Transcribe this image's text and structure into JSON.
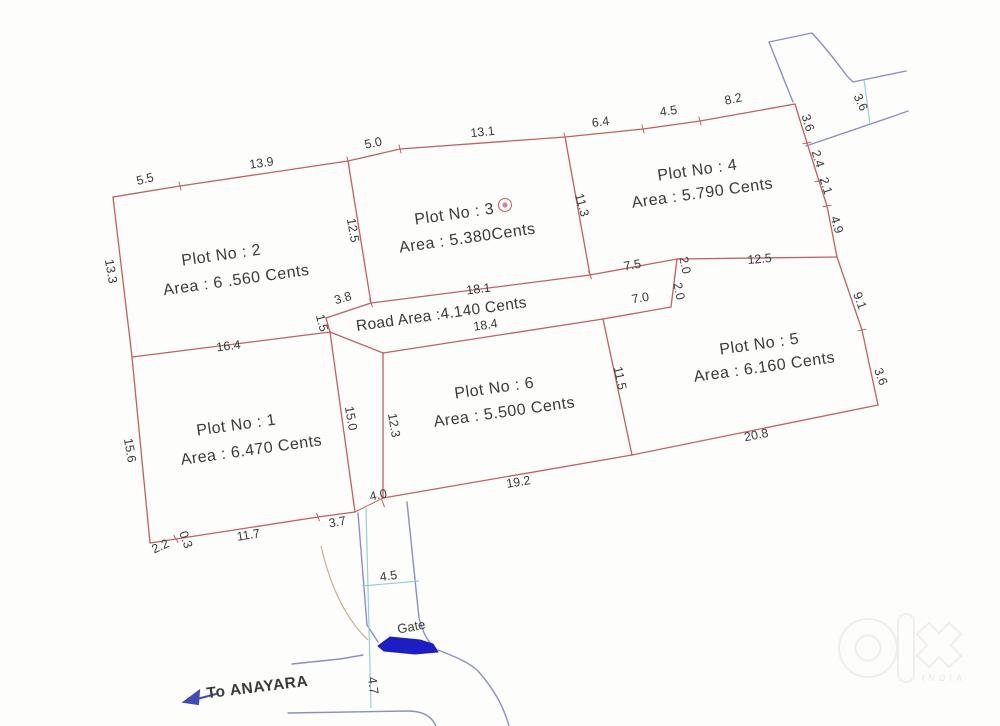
{
  "document_type": "land-plot-survey-sketch",
  "colors": {
    "bg": "#fdfdfc",
    "boundary": "#c16060",
    "text": "#3a3a3a",
    "road_line": "#8b90c0",
    "teal": "#93d2d2",
    "tan": "#c2b193",
    "gate_fill": "#1d1dc6",
    "arrow": "#4349b8",
    "watermark": "#f1eee9"
  },
  "plots": [
    {
      "no": "1",
      "area_cents": "6.470"
    },
    {
      "no": "2",
      "area_cents": "6 .560"
    },
    {
      "no": "3",
      "area_cents": "5.380"
    },
    {
      "no": "4",
      "area_cents": "5.790"
    },
    {
      "no": "5",
      "area_cents": "6.160"
    },
    {
      "no": "6",
      "area_cents": "5.500"
    }
  ],
  "road_area_cents": "4.140",
  "watermark": {
    "logo": "OLX",
    "sub": "INDIA"
  },
  "labels": [
    {
      "name": "dimension-label",
      "cls": "dim",
      "t": "5.5",
      "x": 146,
      "y": 183,
      "r": -14
    },
    {
      "name": "dimension-label",
      "cls": "dim",
      "t": "13.9",
      "x": 262,
      "y": 167,
      "r": -8
    },
    {
      "name": "dimension-label",
      "cls": "dim",
      "t": "5.0",
      "x": 374,
      "y": 147,
      "r": -12
    },
    {
      "name": "dimension-label",
      "cls": "dim",
      "t": "13.1",
      "x": 483,
      "y": 136,
      "r": -6
    },
    {
      "name": "dimension-label",
      "cls": "dim",
      "t": "6.4",
      "x": 601,
      "y": 126,
      "r": -7
    },
    {
      "name": "dimension-label",
      "cls": "dim",
      "t": "4.5",
      "x": 669,
      "y": 115,
      "r": -8
    },
    {
      "name": "dimension-label",
      "cls": "dim",
      "t": "8.2",
      "x": 734,
      "y": 103,
      "r": -12
    },
    {
      "name": "dimension-label",
      "cls": "dim",
      "t": "13.3",
      "x": 107,
      "y": 272,
      "r": 80
    },
    {
      "name": "dimension-label",
      "cls": "dim",
      "t": "12.5",
      "x": 349,
      "y": 231,
      "r": 80
    },
    {
      "name": "dimension-label",
      "cls": "dim",
      "t": "11.3",
      "x": 578,
      "y": 206,
      "r": 75
    },
    {
      "name": "dimension-label",
      "cls": "dim",
      "t": "3.6",
      "x": 804,
      "y": 124,
      "r": 72
    },
    {
      "name": "dimension-label",
      "cls": "dim",
      "t": "2.4",
      "x": 814,
      "y": 160,
      "r": 72
    },
    {
      "name": "dimension-label",
      "cls": "dim",
      "t": "2.1",
      "x": 822,
      "y": 187,
      "r": 72
    },
    {
      "name": "dimension-label",
      "cls": "dim",
      "t": "4.9",
      "x": 833,
      "y": 226,
      "r": 72
    },
    {
      "name": "dimension-label",
      "cls": "dim",
      "t": "12.5",
      "x": 760,
      "y": 263,
      "r": -5
    },
    {
      "name": "dimension-label",
      "cls": "dim",
      "t": "7.5",
      "x": 633,
      "y": 269,
      "r": -10
    },
    {
      "name": "dimension-label",
      "cls": "dim",
      "t": "2.0",
      "x": 681,
      "y": 266,
      "r": 78
    },
    {
      "name": "dimension-label",
      "cls": "dim",
      "t": "2.0",
      "x": 675,
      "y": 292,
      "r": 78
    },
    {
      "name": "dimension-label",
      "cls": "dim",
      "t": "7.0",
      "x": 641,
      "y": 302,
      "r": -10
    },
    {
      "name": "dimension-label",
      "cls": "dim",
      "t": "3.8",
      "x": 344,
      "y": 302,
      "r": -16
    },
    {
      "name": "dimension-label",
      "cls": "dim",
      "t": "18.1",
      "x": 479,
      "y": 293,
      "r": -7
    },
    {
      "name": "dimension-label",
      "cls": "dim",
      "t": "18.4",
      "x": 486,
      "y": 329,
      "r": -8
    },
    {
      "name": "dimension-label",
      "cls": "dim",
      "t": "1.5",
      "x": 318,
      "y": 324,
      "r": 75
    },
    {
      "name": "dimension-label",
      "cls": "dim",
      "t": "9.1",
      "x": 856,
      "y": 302,
      "r": 70
    },
    {
      "name": "dimension-label",
      "cls": "dim",
      "t": "3.6",
      "x": 877,
      "y": 378,
      "r": 70
    },
    {
      "name": "dimension-label",
      "cls": "dim",
      "t": "20.8",
      "x": 757,
      "y": 439,
      "r": -11
    },
    {
      "name": "dimension-label",
      "cls": "dim",
      "t": "11.5",
      "x": 616,
      "y": 379,
      "r": 78
    },
    {
      "name": "dimension-label",
      "cls": "dim",
      "t": "12.3",
      "x": 390,
      "y": 426,
      "r": 80
    },
    {
      "name": "dimension-label",
      "cls": "dim",
      "t": "15.0",
      "x": 347,
      "y": 419,
      "r": 80
    },
    {
      "name": "dimension-label",
      "cls": "dim",
      "t": "19.2",
      "x": 519,
      "y": 486,
      "r": -9
    },
    {
      "name": "dimension-label",
      "cls": "dim",
      "t": "16.4",
      "x": 229,
      "y": 350,
      "r": -7
    },
    {
      "name": "dimension-label",
      "cls": "dim",
      "t": "15.6",
      "x": 126,
      "y": 451,
      "r": 80
    },
    {
      "name": "dimension-label",
      "cls": "dim",
      "t": "2.2",
      "x": 162,
      "y": 550,
      "r": -25
    },
    {
      "name": "dimension-label",
      "cls": "dim",
      "t": "0.3",
      "x": 182,
      "y": 541,
      "r": 70
    },
    {
      "name": "dimension-label",
      "cls": "dim",
      "t": "11.7",
      "x": 249,
      "y": 539,
      "r": -9
    },
    {
      "name": "dimension-label",
      "cls": "dim",
      "t": "3.7",
      "x": 338,
      "y": 526,
      "r": -10
    },
    {
      "name": "dimension-label",
      "cls": "dim",
      "t": "4.0",
      "x": 379,
      "y": 499,
      "r": -12
    },
    {
      "name": "dimension-label",
      "cls": "dim",
      "t": "4.5",
      "x": 389,
      "y": 580,
      "r": -8
    },
    {
      "name": "dimension-label",
      "cls": "dim",
      "t": "4.7",
      "x": 369,
      "y": 686,
      "r": 83
    },
    {
      "name": "dimension-label",
      "cls": "dim",
      "t": "3.6",
      "x": 857,
      "y": 104,
      "r": 65
    },
    {
      "name": "plot-2-title",
      "cls": "plot",
      "t": "Plot No :  2",
      "x": 222,
      "y": 260,
      "r": -8
    },
    {
      "name": "plot-2-area",
      "cls": "plot",
      "t": "Area : 6 .560 Cents",
      "x": 237,
      "y": 285,
      "r": -8
    },
    {
      "name": "plot-3-title",
      "cls": "plot",
      "t": "Plot No : 3",
      "x": 455,
      "y": 219,
      "r": -8
    },
    {
      "name": "plot-3-area",
      "cls": "plot",
      "t": "Area : 5.380Cents",
      "x": 468,
      "y": 243,
      "r": -8
    },
    {
      "name": "plot-4-title",
      "cls": "plot",
      "t": "Plot No :  4",
      "x": 698,
      "y": 175,
      "r": -8
    },
    {
      "name": "plot-4-area",
      "cls": "plot",
      "t": "Area : 5.790 Cents",
      "x": 703,
      "y": 198,
      "r": -8
    },
    {
      "name": "plot-5-title",
      "cls": "plot",
      "t": "Plot No :  5",
      "x": 760,
      "y": 349,
      "r": -8
    },
    {
      "name": "plot-5-area",
      "cls": "plot",
      "t": "Area : 6.160 Cents",
      "x": 765,
      "y": 372,
      "r": -8
    },
    {
      "name": "plot-6-title",
      "cls": "plot",
      "t": "Plot No :  6",
      "x": 495,
      "y": 393,
      "r": -8
    },
    {
      "name": "plot-6-area",
      "cls": "plot",
      "t": "Area : 5.500 Cents",
      "x": 505,
      "y": 417,
      "r": -8
    },
    {
      "name": "plot-1-title",
      "cls": "plot",
      "t": "Plot No : 1",
      "x": 237,
      "y": 430,
      "r": -8
    },
    {
      "name": "plot-1-area",
      "cls": "plot",
      "t": "Area : 6.470  Cents",
      "x": 252,
      "y": 455,
      "r": -8
    },
    {
      "name": "road-area-label",
      "cls": "road",
      "t": "Road Area :4.140 Cents",
      "x": 442,
      "y": 319,
      "r": -8
    },
    {
      "name": "gate-label",
      "cls": "gate",
      "t": "Gate",
      "x": 412,
      "y": 631,
      "r": -10
    },
    {
      "name": "to-anayara-label",
      "cls": "nav",
      "t": "To ANAYARA",
      "x": 258,
      "y": 692,
      "r": -7
    }
  ]
}
